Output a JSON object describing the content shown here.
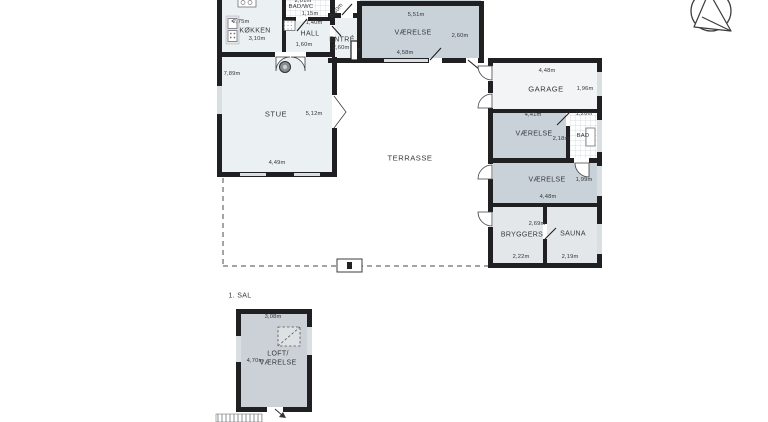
{
  "document": {
    "type": "floor-plan",
    "floor_section_label": "1. SAL",
    "language": "da"
  },
  "colors": {
    "wall": "#202023",
    "ink": "#35383a",
    "window": "#d9dee1",
    "dash": "#4a4a4a",
    "floor_light": "#ebf0f2",
    "floor_mid": "#c9d2d9",
    "floor_pale": "#e3e7ea",
    "floor_garage": "#f2f4f5",
    "floor_loft": "#cbd1d6"
  },
  "symbols": [
    "north-arrow",
    "kitchen-sink",
    "cooktop",
    "wood-stove",
    "shower-drain",
    "skylight",
    "loft-access-arrow",
    "ladder-hatch"
  ],
  "rooms": {
    "ground_floor": [
      {
        "label": "KØKKEN",
        "dims": [
          "2,75m",
          "3,10m"
        ]
      },
      {
        "label": "BAD/WC",
        "dims": [
          "2,01m",
          "1,15m",
          "1,40m"
        ]
      },
      {
        "label": "HALL",
        "dims": [
          "1,60m"
        ]
      },
      {
        "label": "ENTRÉ",
        "dims": [
          "2,60m",
          "0,40m"
        ]
      },
      {
        "label": "VÆRELSE",
        "dims": [
          "5,51m",
          "2,60m",
          "4,58m"
        ]
      },
      {
        "label": "STUE",
        "dims": [
          "7,89m",
          "5,12m",
          "4,49m"
        ]
      },
      {
        "label": "TERRASSE",
        "dims": []
      },
      {
        "label": "GARAGE",
        "dims": [
          "4,48m",
          "1,96m"
        ]
      },
      {
        "label": "VÆRELSE",
        "dims": [
          "4,41m",
          "2,18m"
        ]
      },
      {
        "label": "BAD",
        "dims": [
          "1,20m"
        ]
      },
      {
        "label": "VÆRELSE",
        "dims": [
          "1,99m",
          "4,48m"
        ]
      },
      {
        "label": "BRYGGERS",
        "dims": [
          "2,69m",
          "2,22m"
        ]
      },
      {
        "label": "SAUNA",
        "dims": [
          "2,19m"
        ]
      },
      {
        "label": "s",
        "dims": []
      }
    ],
    "first_floor": [
      {
        "label": "LOFT/VÆRELSE",
        "dims": [
          "3,08m",
          "4,70m"
        ]
      }
    ]
  },
  "labels": [
    {
      "t": "2,01m",
      "x": 303,
      "y": 1,
      "type": "dim"
    },
    {
      "t": "BAD/WC",
      "x": 301,
      "y": 7,
      "type": "room",
      "size": "s"
    },
    {
      "t": "1,15m",
      "x": 310,
      "y": 14,
      "type": "dim"
    },
    {
      "t": "1,40m",
      "x": 314,
      "y": 23,
      "type": "dim"
    },
    {
      "t": "2,75m",
      "x": 241,
      "y": 22,
      "type": "dim"
    },
    {
      "t": "KØKKEN",
      "x": 255,
      "y": 31,
      "type": "room"
    },
    {
      "t": "3,10m",
      "x": 257,
      "y": 39,
      "type": "dim"
    },
    {
      "t": "HALL",
      "x": 310,
      "y": 34,
      "type": "room"
    },
    {
      "t": "1,60m",
      "x": 304,
      "y": 45,
      "type": "dim"
    },
    {
      "t": "ENTRÉ",
      "x": 342,
      "y": 40,
      "type": "room"
    },
    {
      "t": "2,60m",
      "x": 341,
      "y": 48,
      "type": "dim"
    },
    {
      "t": "s",
      "x": 359,
      "y": 50,
      "type": "room",
      "size": "s"
    },
    {
      "t": "0,40m",
      "x": 337,
      "y": 11,
      "type": "dim",
      "rot": -52
    },
    {
      "t": "5,51m",
      "x": 416,
      "y": 15,
      "type": "dim"
    },
    {
      "t": "VÆRELSE",
      "x": 413,
      "y": 33,
      "type": "room"
    },
    {
      "t": "2,60m",
      "x": 460,
      "y": 36,
      "type": "dim"
    },
    {
      "t": "4,58m",
      "x": 405,
      "y": 53,
      "type": "dim"
    },
    {
      "t": "7,89m",
      "x": 232,
      "y": 74,
      "type": "dim"
    },
    {
      "t": "STUE",
      "x": 276,
      "y": 114,
      "type": "room",
      "size": "l"
    },
    {
      "t": "5,12m",
      "x": 314,
      "y": 114,
      "type": "dim"
    },
    {
      "t": "4,49m",
      "x": 277,
      "y": 163,
      "type": "dim"
    },
    {
      "t": "TERRASSE",
      "x": 410,
      "y": 158,
      "type": "room",
      "size": "l"
    },
    {
      "t": "4,48m",
      "x": 547,
      "y": 71,
      "type": "dim"
    },
    {
      "t": "GARAGE",
      "x": 546,
      "y": 89,
      "type": "room",
      "size": "l"
    },
    {
      "t": "1,96m",
      "x": 585,
      "y": 89,
      "type": "dim"
    },
    {
      "t": "4,41m",
      "x": 533,
      "y": 115,
      "type": "dim"
    },
    {
      "t": "VÆRELSE",
      "x": 534,
      "y": 134,
      "type": "room"
    },
    {
      "t": "2,18m",
      "x": 561,
      "y": 139,
      "type": "dim"
    },
    {
      "t": "1,20m",
      "x": 584,
      "y": 114,
      "type": "dim"
    },
    {
      "t": "BAD",
      "x": 583,
      "y": 136,
      "type": "room",
      "size": "s"
    },
    {
      "t": "VÆRELSE",
      "x": 547,
      "y": 180,
      "type": "room"
    },
    {
      "t": "1,99m",
      "x": 584,
      "y": 180,
      "type": "dim"
    },
    {
      "t": "4,48m",
      "x": 548,
      "y": 197,
      "type": "dim"
    },
    {
      "t": "2,69m",
      "x": 537,
      "y": 224,
      "type": "dim"
    },
    {
      "t": "BRYGGERS",
      "x": 522,
      "y": 235,
      "type": "room"
    },
    {
      "t": "SAUNA",
      "x": 573,
      "y": 234,
      "type": "room"
    },
    {
      "t": "2,22m",
      "x": 521,
      "y": 257,
      "type": "dim"
    },
    {
      "t": "2,19m",
      "x": 570,
      "y": 257,
      "type": "dim"
    },
    {
      "t": "1. SAL",
      "x": 240,
      "y": 296,
      "type": "room"
    },
    {
      "t": "3,08m",
      "x": 273,
      "y": 317,
      "type": "dim"
    },
    {
      "t": "LOFT/",
      "x": 278,
      "y": 354,
      "type": "room"
    },
    {
      "t": "VÆRELSE",
      "x": 278,
      "y": 363,
      "type": "room"
    },
    {
      "t": "4,70m",
      "x": 255,
      "y": 361,
      "type": "dim"
    }
  ]
}
